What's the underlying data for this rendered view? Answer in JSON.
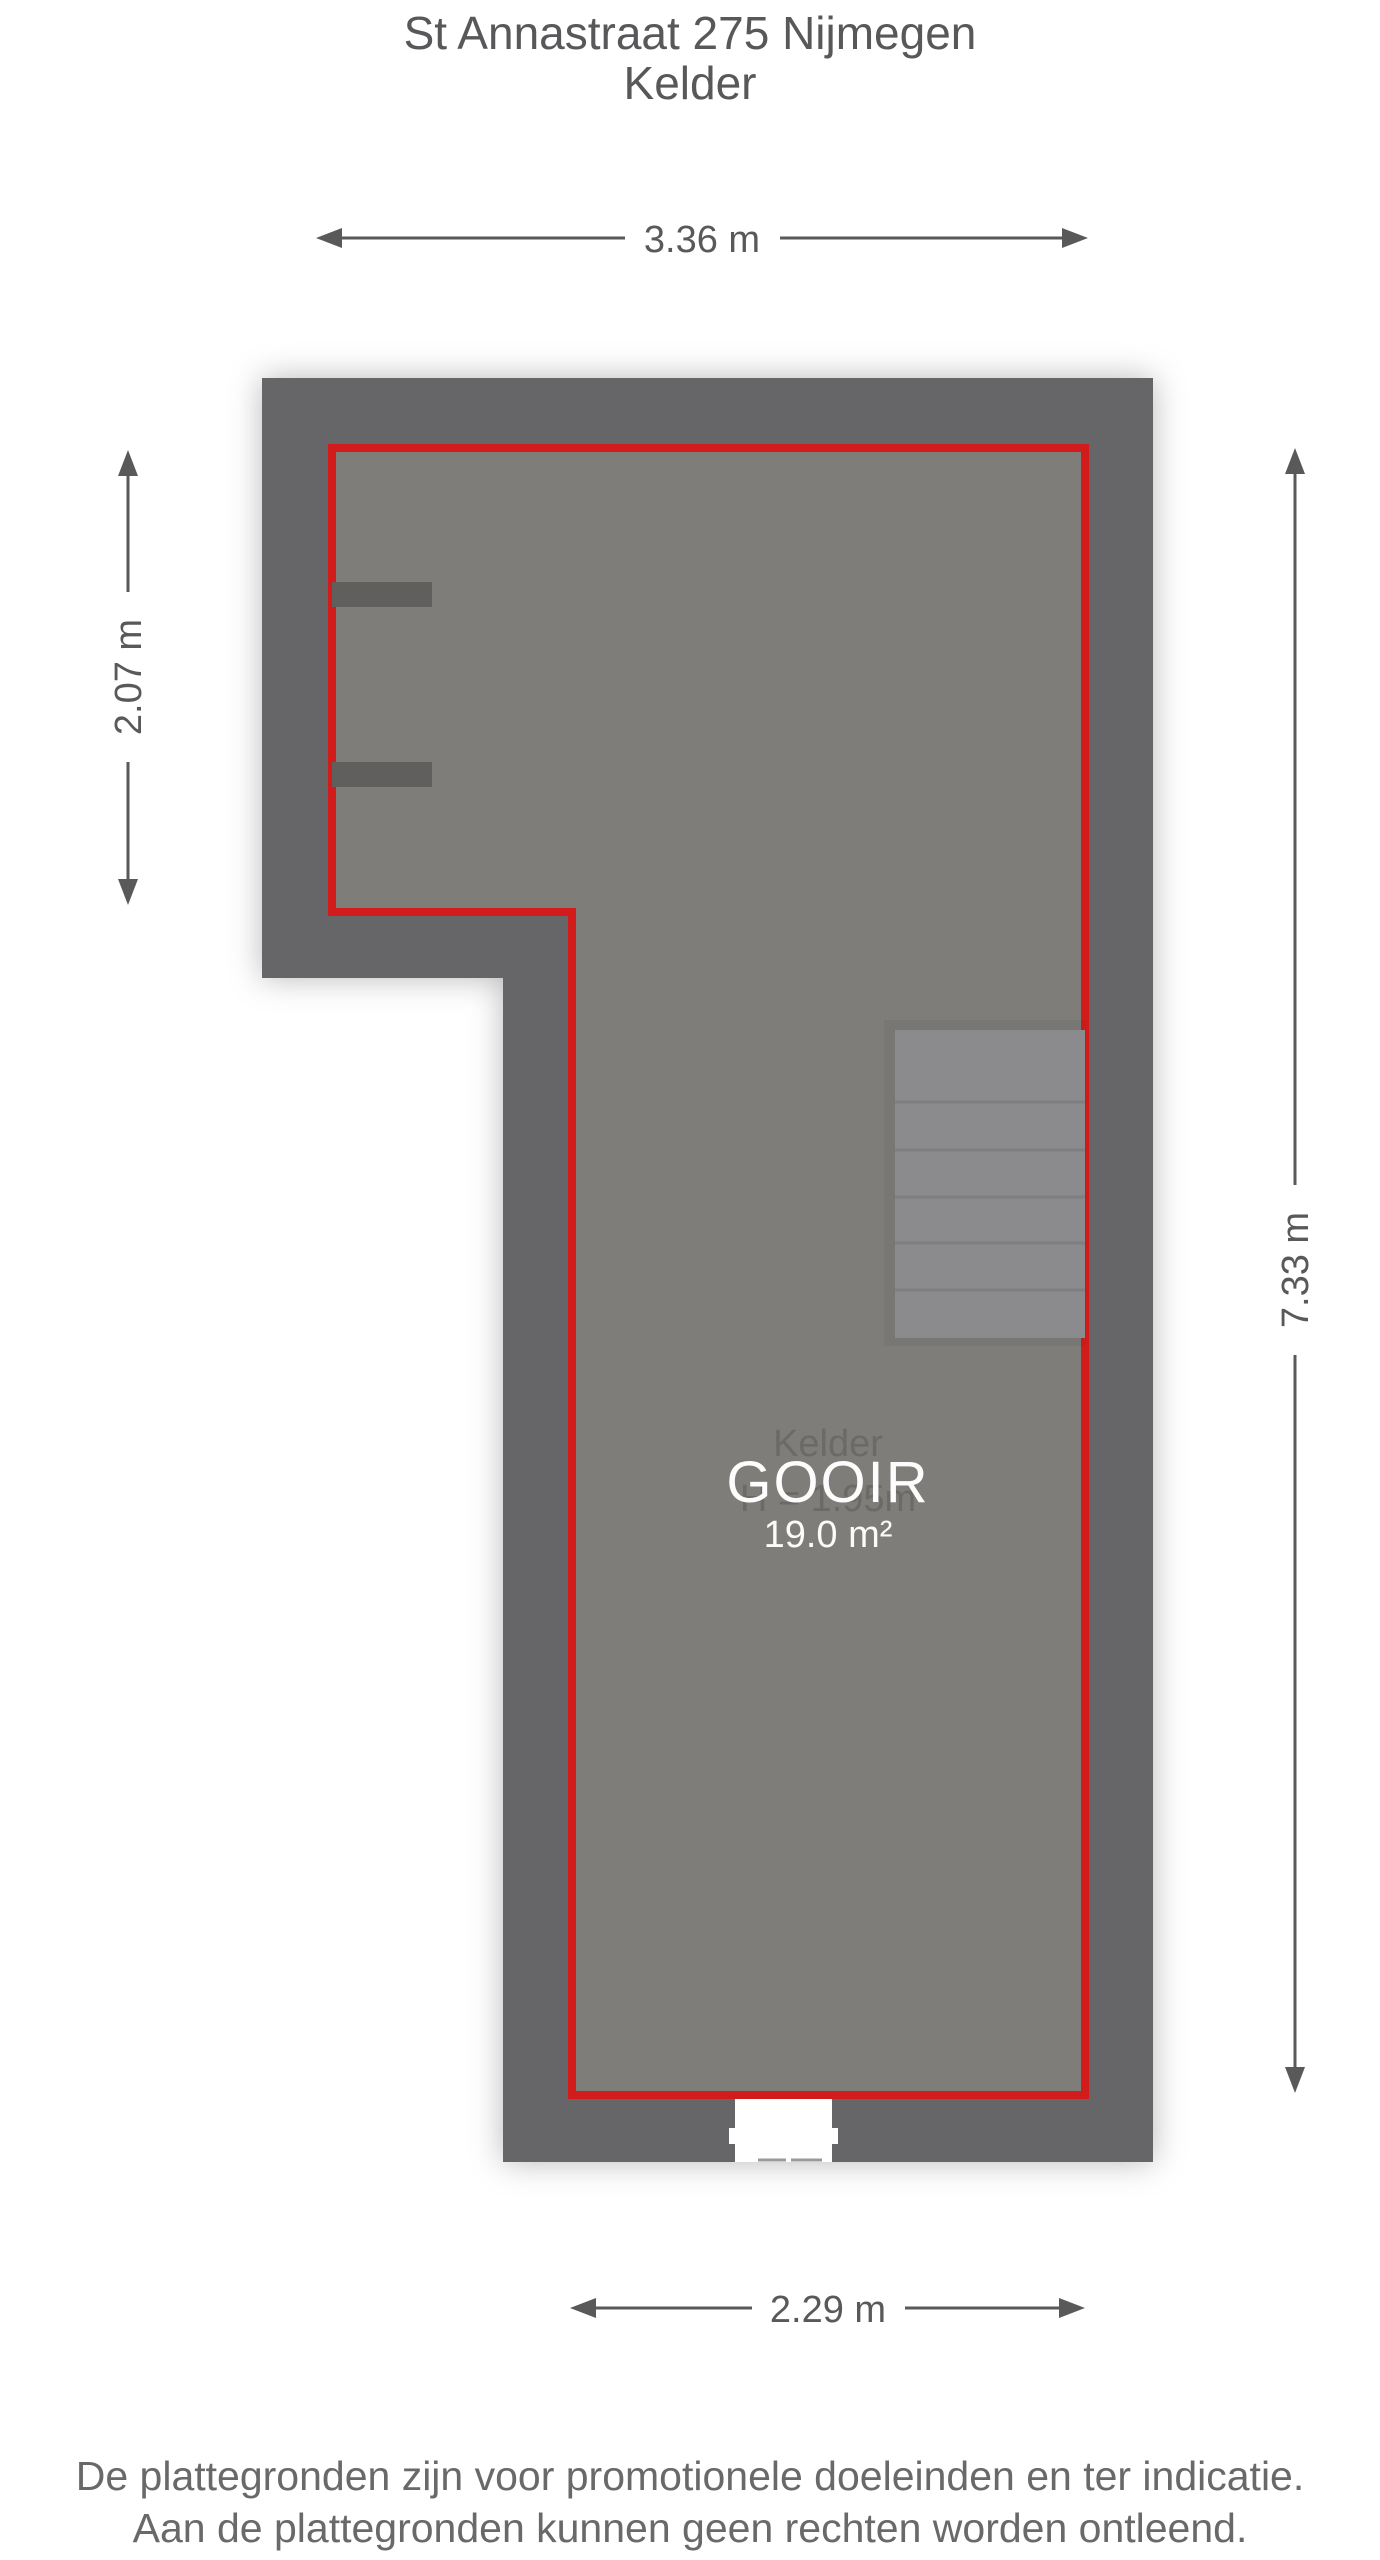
{
  "header": {
    "title": "St Annastraat 275 Nijmegen",
    "subtitle": "Kelder"
  },
  "floorplan": {
    "room": {
      "name": "Kelder",
      "watermark": "GOOIR",
      "ceiling_height": "H = 1.95m",
      "area": "19.0 m²"
    },
    "dimensions": {
      "top": "3.36 m",
      "left": "2.07 m",
      "right": "7.33 m",
      "bottom": "2.29 m"
    },
    "colors": {
      "wall": "#666567",
      "floor": "#7f7d79",
      "room_outline_red": "#d21b1b",
      "stairs": "#8b8a8c",
      "dimension_lines": "#595959",
      "watermark_text": "#fdfdfd"
    }
  },
  "footer": {
    "disclaimer_line1": "De plattegronden zijn voor promotionele doeleinden en ter indicatie.",
    "disclaimer_line2": "Aan de plattegronden kunnen geen rechten worden ontleend."
  }
}
